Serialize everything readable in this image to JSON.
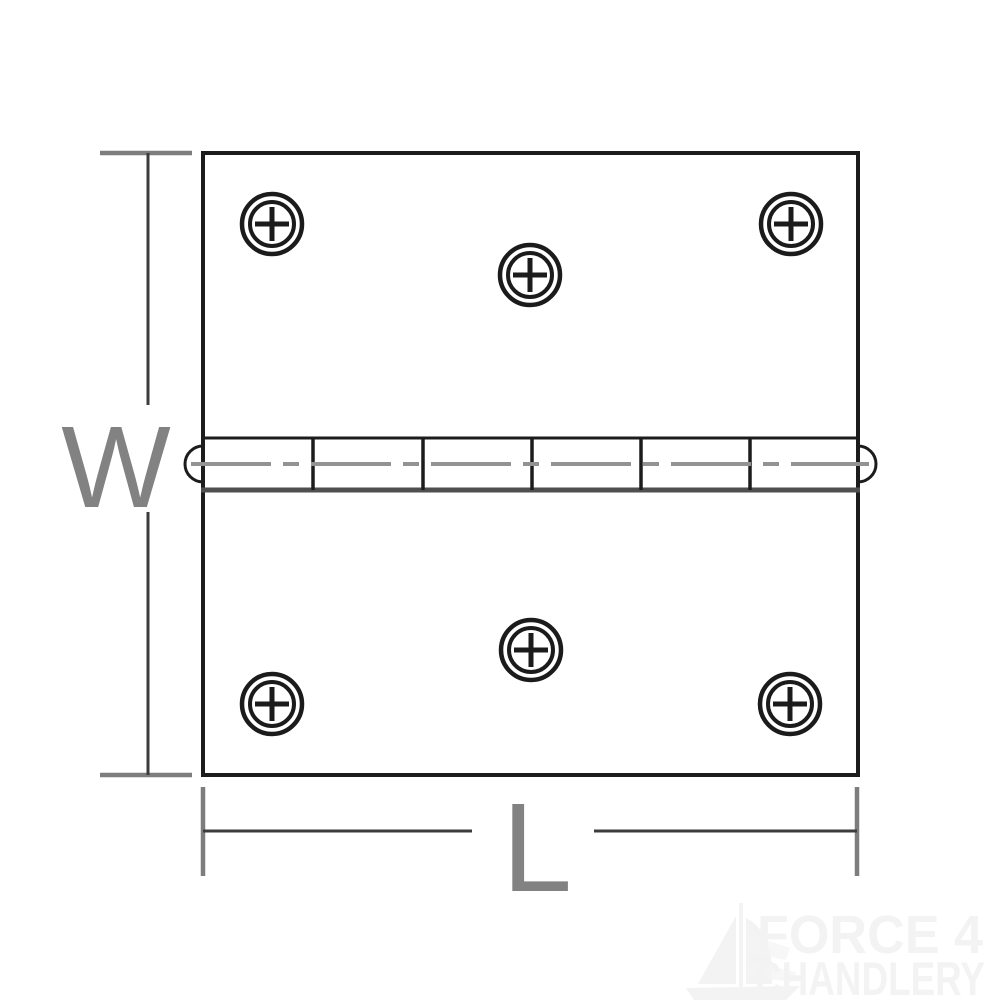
{
  "diagram": {
    "kind": "technical-dimension-drawing",
    "subject_labels": {
      "width": "W",
      "length": "L"
    },
    "screw_hole_count": 6,
    "knuckle_segment_count": 6
  },
  "watermark": {
    "line1": "FORCE 4",
    "line2": "CHANDLERY"
  },
  "colors": {
    "background": "#ffffff",
    "outline": "#1c1c1c",
    "barrel_shadow_line": "#4f4f4f",
    "pin_centerline": "#939393",
    "dimension_line": "#3c3c3c",
    "dimension_tick": "#7d7d7d",
    "dimension_label": "#828282",
    "watermark": "#f3f3f3"
  }
}
